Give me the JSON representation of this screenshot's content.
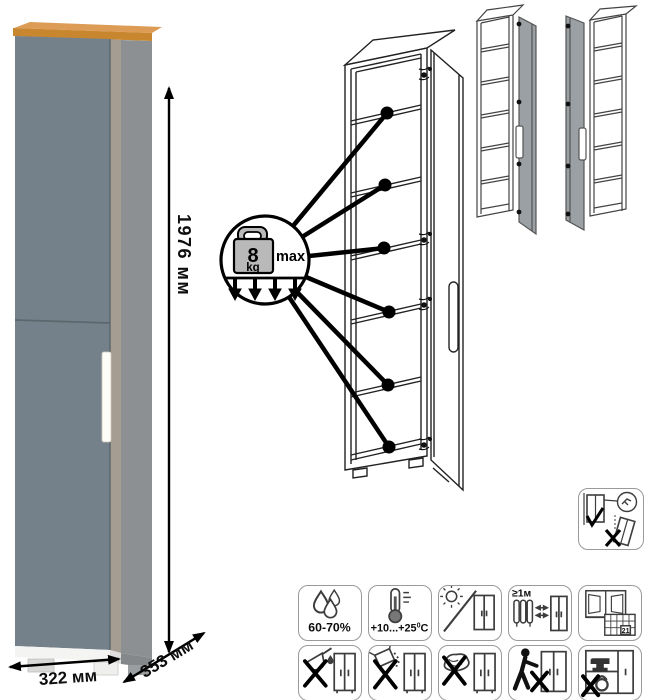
{
  "product_view": {
    "dim_height": "1976 мм",
    "dim_width": "322 мм",
    "dim_depth": "353 мм"
  },
  "shelf_diagram": {
    "load_value": "8",
    "load_unit": "kg",
    "load_qualifier": "max",
    "shelf_count": 6
  },
  "care_icons": {
    "humidity_label": "60-70%",
    "temp_main": "+10...+25",
    "temp_sup": "0",
    "temp_unit": "C",
    "distance_label": "≥1м",
    "calendar_day": "21"
  },
  "colors": {
    "wood_top": "#c8862f",
    "wood_top_light": "#dc9c55",
    "door_gray": "#75818a",
    "side_gray": "#8d9092",
    "edge_tan": "#a59d91",
    "variant_door_gray": "#9aa0a4",
    "weight_gray": "#b9b9b9",
    "outline": "#222222",
    "icon_ink": "#3d3d3d"
  }
}
